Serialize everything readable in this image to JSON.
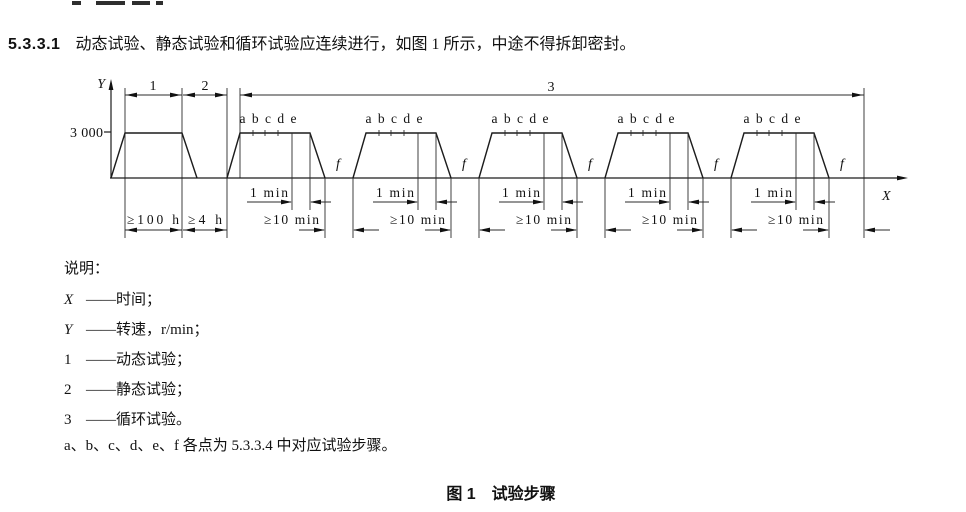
{
  "page": {
    "clause": {
      "number": "5.3.3.1",
      "text": "动态试验、静态试验和循环试验应连续进行，如图 1 所示，中途不得拆卸密封。"
    },
    "figure": {
      "y_axis_label": "Y",
      "x_axis_label": "X",
      "y_tick_value": "3 000",
      "dim1_label": "1",
      "dim2_label": "2",
      "dim3_label": "3",
      "dur_dynamic": "≥100 h",
      "dur_static": "≥4 h",
      "dur_ramp": "1 min",
      "dur_pause": "≥10 min",
      "cycle_points": "a b c d e",
      "point_f": "f"
    },
    "legend": {
      "title": "说明：",
      "items": [
        {
          "term": "X",
          "italic": true,
          "def": "——时间；"
        },
        {
          "term": "Y",
          "italic": true,
          "def": "——转速，r/min；"
        },
        {
          "term": "1",
          "italic": false,
          "def": "——动态试验；"
        },
        {
          "term": "2",
          "italic": false,
          "def": "——静态试验；"
        },
        {
          "term": "3",
          "italic": false,
          "def": "——循环试验。"
        }
      ],
      "note": "a、b、c、d、e、f 各点为 5.3.3.4 中对应试验步骤。"
    },
    "caption": "图 1　试验步骤"
  }
}
